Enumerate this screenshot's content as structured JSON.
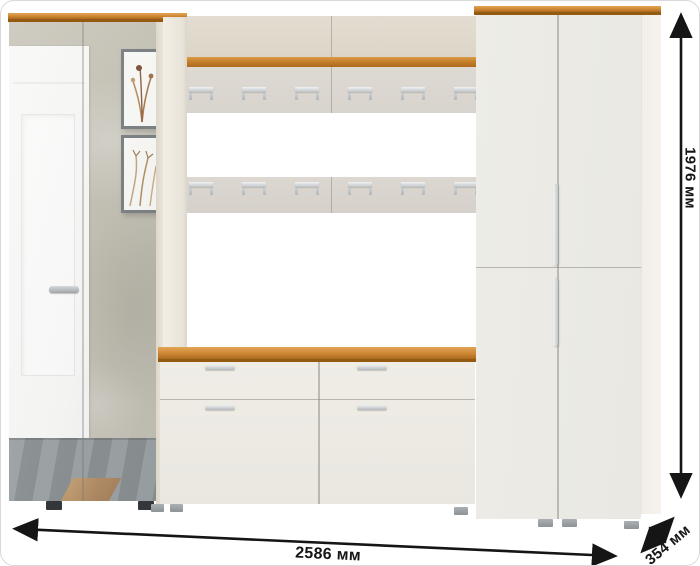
{
  "annotations": {
    "width_label": "2586 мм",
    "height_label": "1976 мм",
    "depth_label": "354 мм"
  },
  "dimensions": {
    "width_mm": 2586,
    "height_mm": 1976,
    "depth_mm": 354,
    "unit": "мм"
  },
  "palette": {
    "background": "#ffffff",
    "arrow_color": "#151515",
    "wood_accent": "#c67f2a",
    "cabinet_front": "#edebe4",
    "hook_panel": "#dcd8d1",
    "upper_band": "#e0dacd",
    "concrete_wall": "#c3bfb2",
    "floor_tile": "#8d9193",
    "hardware_silver": "#c9cdd0"
  },
  "scene": {
    "hook_rows": 2,
    "hooks_per_row": 6,
    "pieces": [
      "mirror-wardrobe",
      "wall-hook-panel",
      "top-shelf",
      "shoe-bench",
      "double-wardrobe"
    ]
  }
}
